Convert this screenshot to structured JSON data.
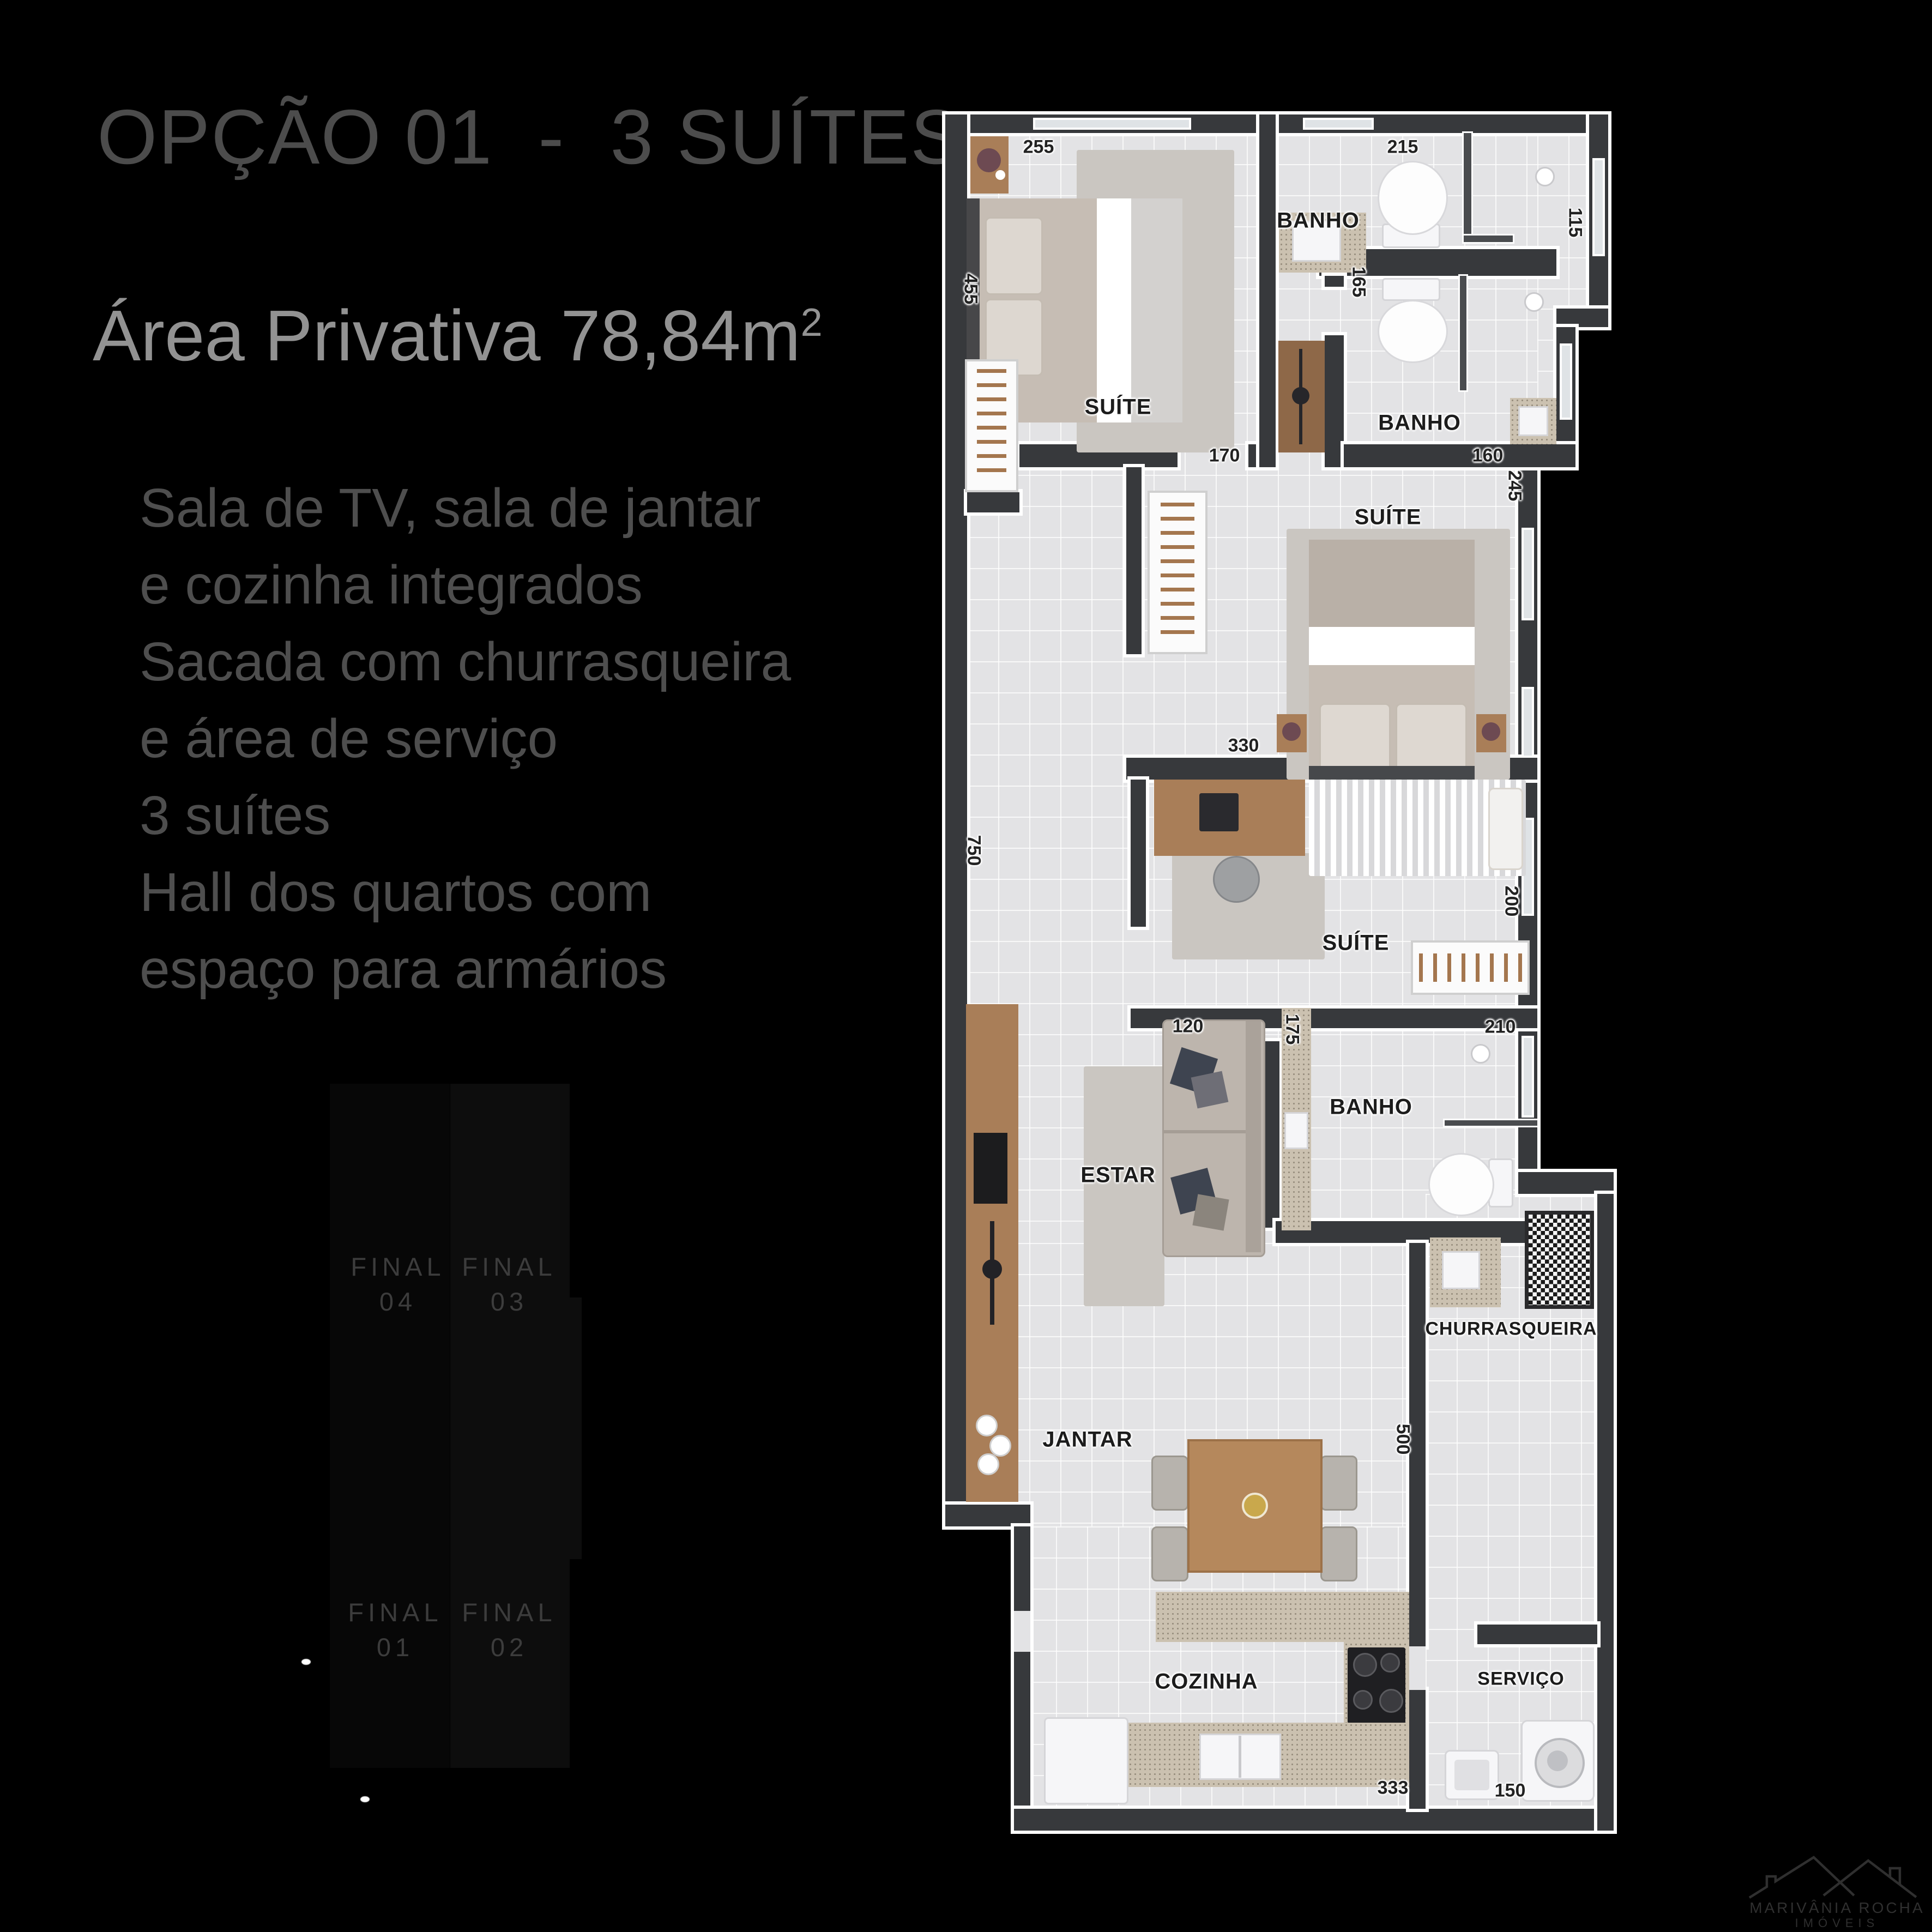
{
  "info_panel": {
    "title": "OPÇÃO 01  -  3 SUÍTES",
    "area_label": "Área Privativa 78,84m",
    "area_sup": "2",
    "description": "Sala de TV, sala de jantar\ne cozinha integrados\nSacada com churrasqueira\ne área de serviço\n3 suítes\nHall dos quartos com\nespaço para armários"
  },
  "key_plan": {
    "units": [
      {
        "id": "final-04",
        "text": "FINAL\n04"
      },
      {
        "id": "final-03",
        "text": "FINAL\n03"
      },
      {
        "id": "final-01",
        "text": "FINAL\n01"
      },
      {
        "id": "final-02",
        "text": "FINAL\n02"
      }
    ]
  },
  "floor_plan": {
    "rooms": [
      {
        "id": "suite-1",
        "label": "SUÍTE"
      },
      {
        "id": "banho-1",
        "label": "BANHO"
      },
      {
        "id": "banho-2",
        "label": "BANHO"
      },
      {
        "id": "suite-2",
        "label": "SUÍTE"
      },
      {
        "id": "suite-3",
        "label": "SUÍTE"
      },
      {
        "id": "banho-3",
        "label": "BANHO"
      },
      {
        "id": "estar",
        "label": "ESTAR"
      },
      {
        "id": "jantar",
        "label": "JANTAR"
      },
      {
        "id": "cozinha",
        "label": "COZINHA"
      },
      {
        "id": "churrasqueira",
        "label": "CHURRASQUEIRA"
      },
      {
        "id": "servico",
        "label": "SERVIÇO"
      }
    ],
    "dims": [
      {
        "id": "dim-255",
        "value": "255"
      },
      {
        "id": "dim-215",
        "value": "215"
      },
      {
        "id": "dim-115",
        "value": "115"
      },
      {
        "id": "dim-165",
        "value": "165"
      },
      {
        "id": "dim-170",
        "value": "170"
      },
      {
        "id": "dim-160",
        "value": "160"
      },
      {
        "id": "dim-245",
        "value": "245"
      },
      {
        "id": "dim-455",
        "value": "455"
      },
      {
        "id": "dim-330",
        "value": "330"
      },
      {
        "id": "dim-750",
        "value": "750"
      },
      {
        "id": "dim-200",
        "value": "200"
      },
      {
        "id": "dim-120",
        "value": "120"
      },
      {
        "id": "dim-175",
        "value": "175"
      },
      {
        "id": "dim-210",
        "value": "210"
      },
      {
        "id": "dim-500",
        "value": "500"
      },
      {
        "id": "dim-333",
        "value": "333"
      },
      {
        "id": "dim-150",
        "value": "150"
      }
    ]
  },
  "logo": {
    "line1": "MARIVÂNIA ROCHA",
    "line2": "IMÓVEIS"
  },
  "colors": {
    "background": "#000000",
    "title_text": "#4c4c4c",
    "area_text": "#929292",
    "description_text": "#4e4e4e",
    "keyplan_text": "#3c3c3c",
    "wall": "#37393c",
    "floor": "#e3e3e5",
    "wood": "#a97e58",
    "granite": "#cbc1b0",
    "logo_text": "#2f2f2f"
  }
}
